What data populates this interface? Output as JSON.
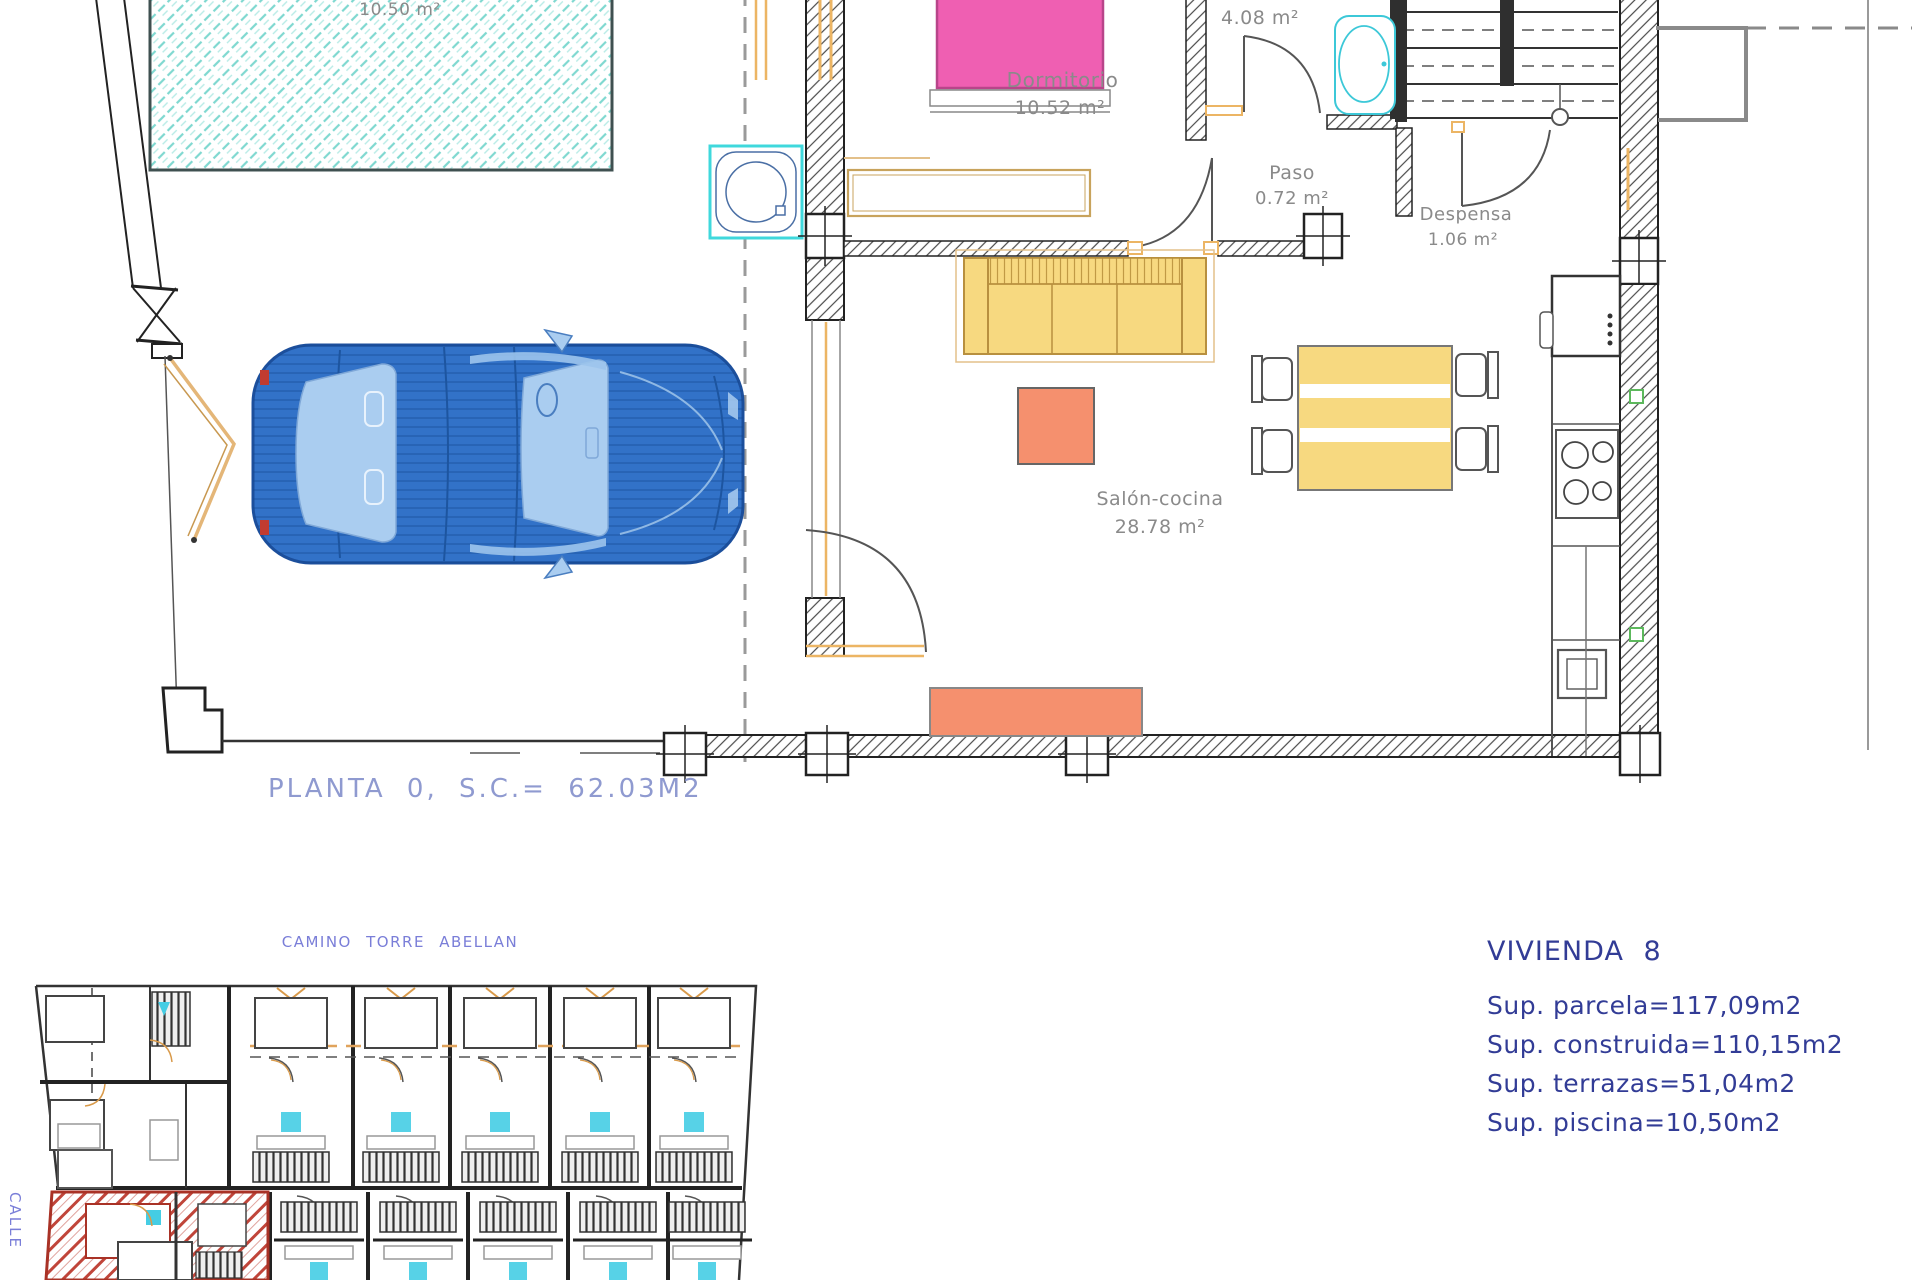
{
  "floor_plan": {
    "pool_area": "10.50 m²",
    "rooms": {
      "dormitorio": {
        "name": "Dormitorio",
        "area": "10.52 m²"
      },
      "bano": {
        "name": "Baño",
        "area": "4.08 m²"
      },
      "paso": {
        "name": "Paso",
        "area": "0.72 m²"
      },
      "despensa": {
        "name": "Despensa",
        "area": "1.06 m²"
      },
      "salon": {
        "name": "Salón-cocina",
        "area": "28.78 m²"
      }
    },
    "title": "PLANTA 0, S.C.= 62.03M2"
  },
  "site_plan": {
    "street_top": "CAMINO TORRE ABELLAN",
    "street_left": "CALLE"
  },
  "summary": {
    "title": "VIVIENDA 8",
    "lines": [
      "Sup. parcela=117,09m2",
      "Sup. construida=110,15m2",
      "Sup. terrazas=51,04m2",
      "Sup. piscina=10,50m2"
    ]
  },
  "colors": {
    "pool_hatch": "#7fd8d0",
    "wall": "#222222",
    "car_body": "#3272c8",
    "car_glass": "#aacdf0",
    "bed_pink": "#ef5fb2",
    "furniture_yellow": "#f7d980",
    "furniture_orange": "#f5906e",
    "door_accent": "#e8b061",
    "label_gray": "#8a8a8a",
    "plan_title_blue": "#8f9ad0",
    "street_blue": "#7a7ed8",
    "summary_navy": "#323c96",
    "highlight_red": "#c0453a",
    "stair_cyan": "#45cde4"
  }
}
